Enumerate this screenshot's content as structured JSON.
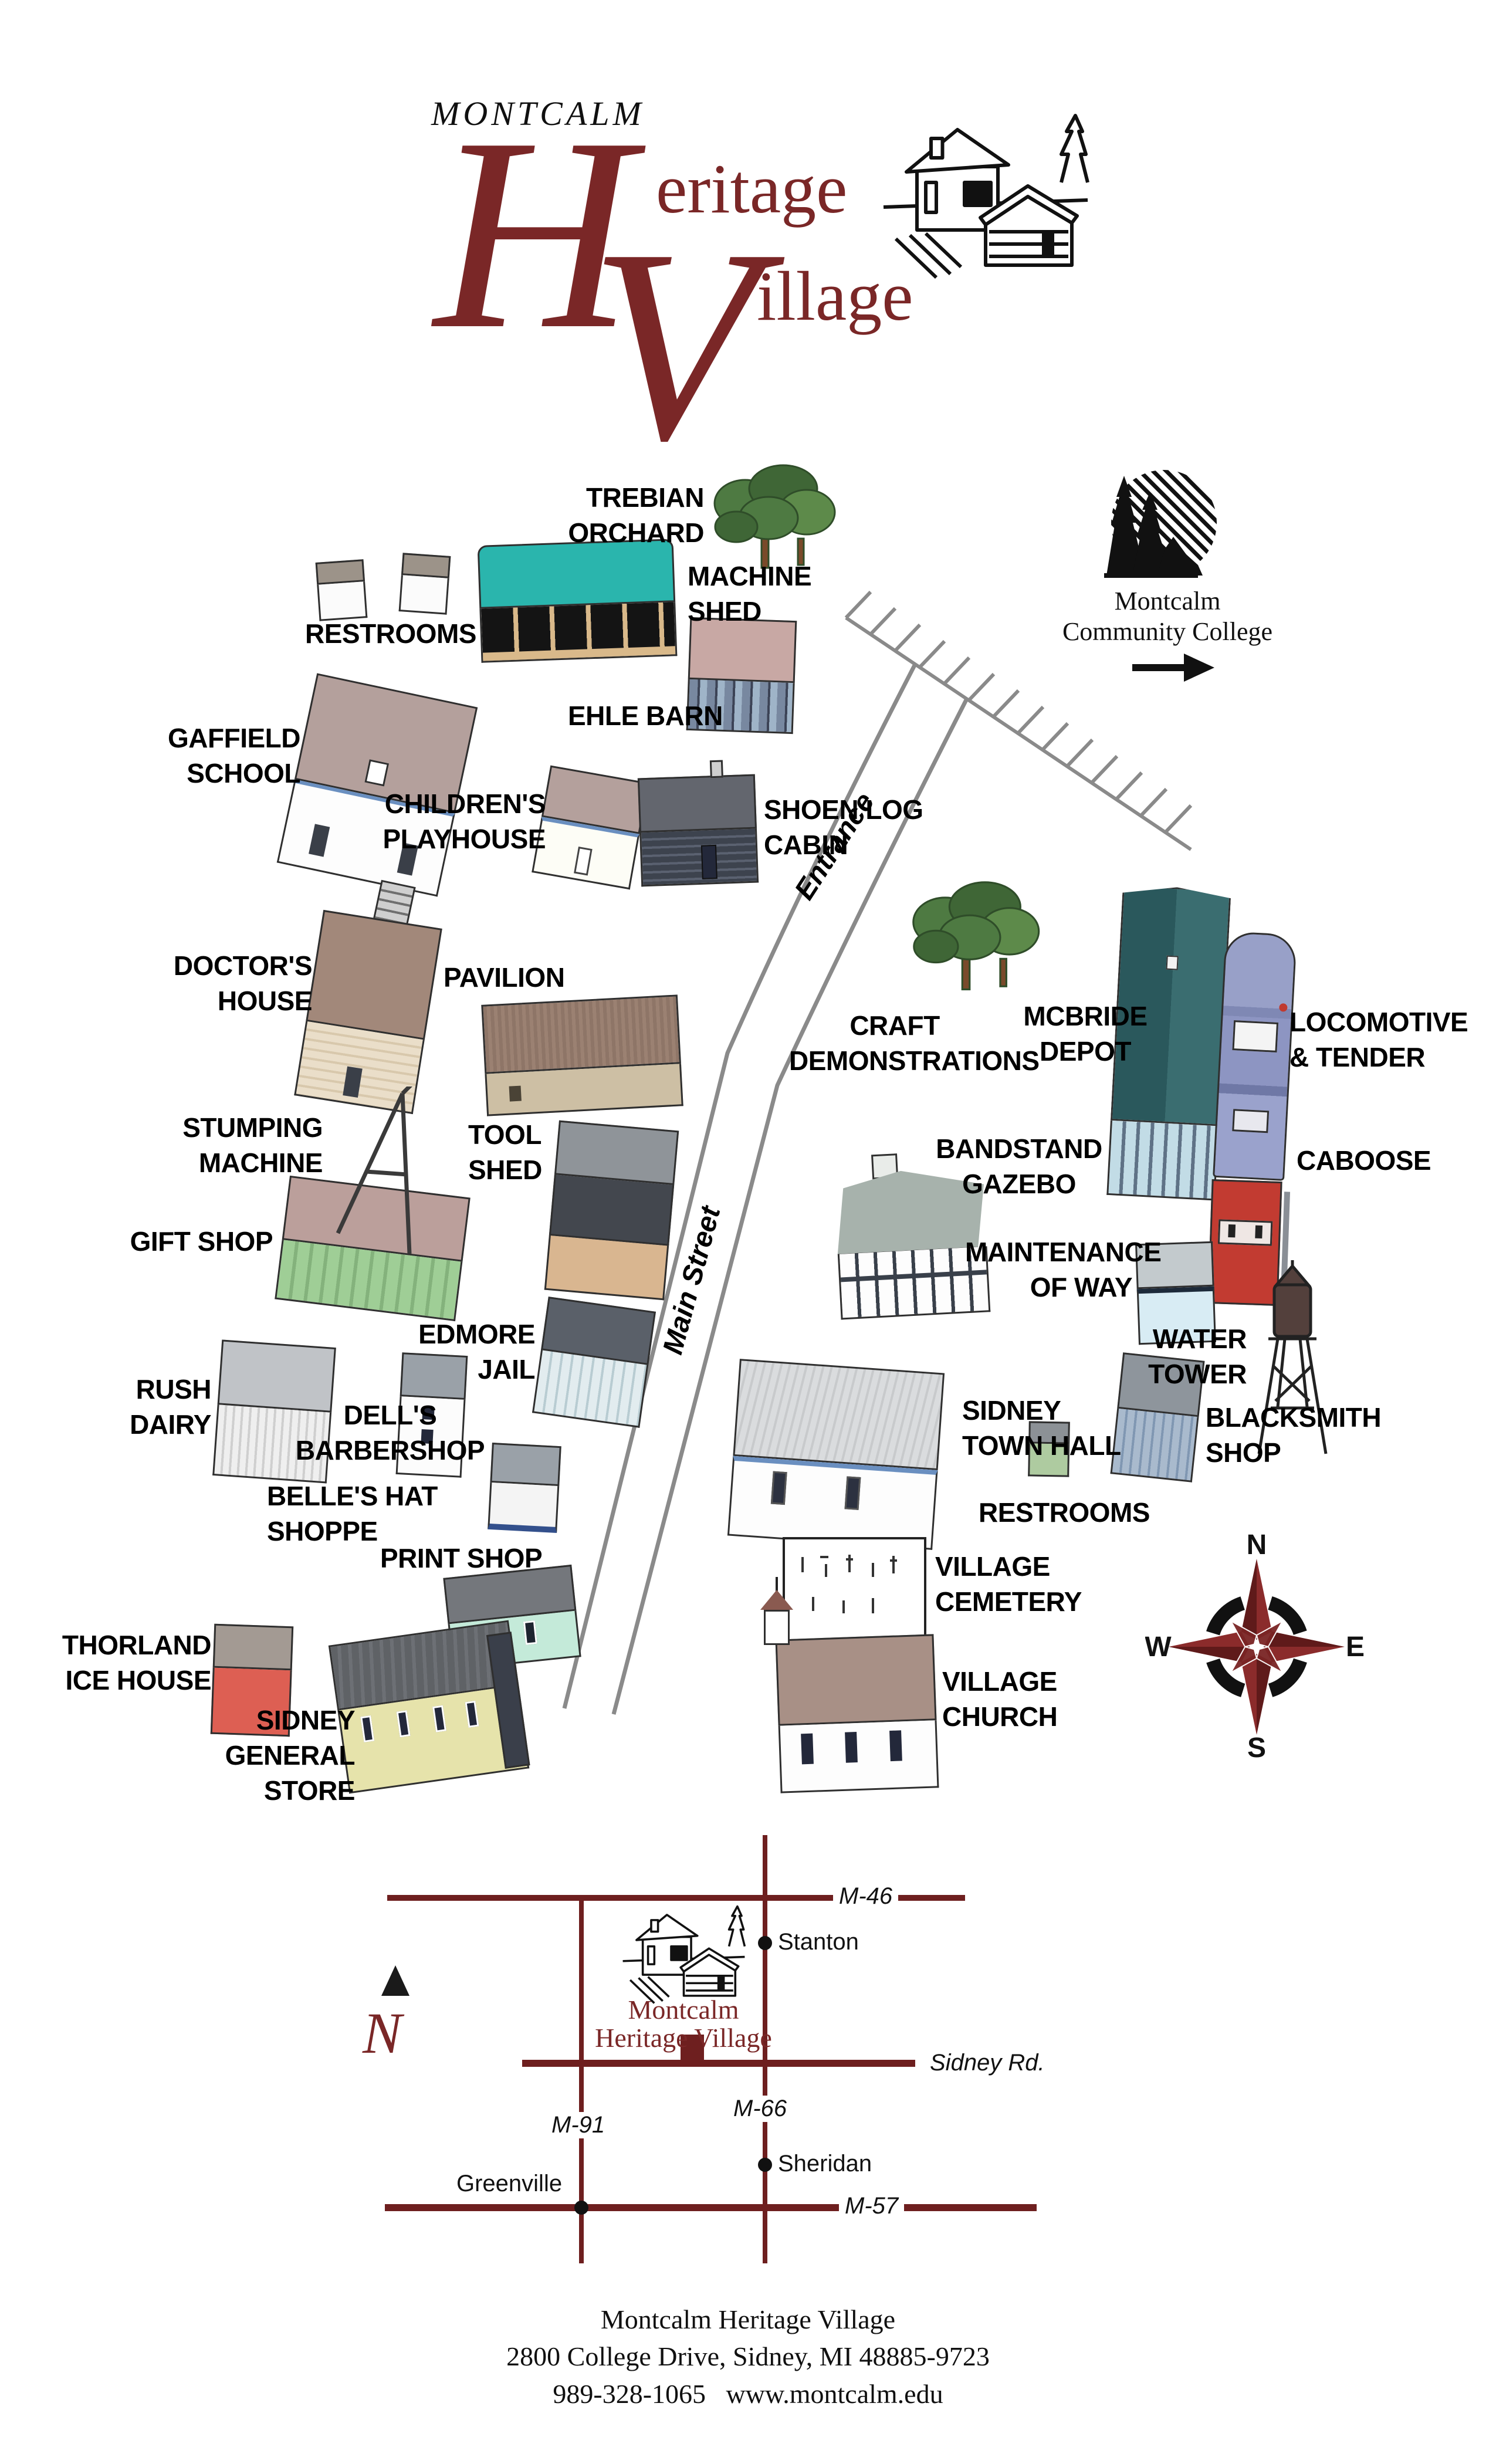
{
  "logo": {
    "kicker": "MONTCALM",
    "heritage_initial": "H",
    "heritage_rest": "eritage",
    "village_initial": "V",
    "village_rest": "illage"
  },
  "college": {
    "line1": "Montcalm",
    "line2": "Community College"
  },
  "roads": {
    "entrance": "Entrance",
    "main_street": "Main Street"
  },
  "labels": {
    "trebian": [
      "TREBIAN",
      "ORCHARD"
    ],
    "machine_shed": [
      "MACHINE",
      "SHED"
    ],
    "restrooms_nw": [
      "RESTROOMS"
    ],
    "ehle_barn": [
      "EHLE BARN"
    ],
    "gaffield": [
      "GAFFIELD",
      "SCHOOL"
    ],
    "childrens": [
      "CHILDREN'S",
      "PLAYHOUSE"
    ],
    "shoen": [
      "SHOEN LOG",
      "CABIN"
    ],
    "doctors": [
      "DOCTOR'S",
      "HOUSE"
    ],
    "pavilion": [
      "PAVILION"
    ],
    "craft": [
      "CRAFT",
      "DEMONSTRATIONS"
    ],
    "mcbride": [
      "MCBRIDE",
      "DEPOT"
    ],
    "locomotive": [
      "LOCOMOTIVE",
      "& TENDER"
    ],
    "caboose": [
      "CABOOSE"
    ],
    "stumping": [
      "STUMPING",
      "MACHINE"
    ],
    "tool_shed": [
      "TOOL",
      "SHED"
    ],
    "gift_shop": [
      "GIFT SHOP"
    ],
    "bandstand": [
      "BANDSTAND",
      "GAZEBO"
    ],
    "maintenance": [
      "MAINTENANCE",
      "OF WAY"
    ],
    "water_tower": [
      "WATER",
      "TOWER"
    ],
    "edmore": [
      "EDMORE",
      "JAIL"
    ],
    "rush": [
      "RUSH",
      "DAIRY"
    ],
    "dells": [
      "DELL'S",
      "BARBERSHOP"
    ],
    "belles": [
      "BELLE'S HAT SHOPPE"
    ],
    "town_hall": [
      "SIDNEY",
      "TOWN HALL"
    ],
    "restrooms_se": [
      "RESTROOMS"
    ],
    "blacksmith": [
      "BLACKSMITH",
      "SHOP"
    ],
    "print_shop": [
      "PRINT SHOP"
    ],
    "thorland": [
      "THORLAND",
      "ICE HOUSE"
    ],
    "general_store": [
      "SIDNEY",
      "GENERAL STORE"
    ],
    "cemetery": [
      "VILLAGE",
      "CEMETERY"
    ],
    "church": [
      "VILLAGE",
      "CHURCH"
    ]
  },
  "compass": {
    "n": "N",
    "e": "E",
    "s": "S",
    "w": "W"
  },
  "inset": {
    "m46": "M-46",
    "m91": "M-91",
    "m66": "M-66",
    "m57": "M-57",
    "sidney_rd": "Sidney Rd.",
    "stanton": "Stanton",
    "sheridan": "Sheridan",
    "greenville": "Greenville",
    "mhv_line1": "Montcalm",
    "mhv_line2": "Heritage Village",
    "north": "N"
  },
  "footer": {
    "line1": "Montcalm Heritage Village",
    "line2": "2800 College Drive, Sidney, MI 48885-9723",
    "line3": "989-328-1065   www.montcalm.edu"
  },
  "colors": {
    "brand_maroon": "#7a2727",
    "compass_red": "#6e2020",
    "inset_road_red": "#6e1f1f",
    "road_gray": "#8a8a8a",
    "machine_shed_teal": "#2ab5ad",
    "depot_teal": "#2e5f62",
    "caboose_red": "#c23b31",
    "ice_house_red": "#dd5f53",
    "store_yellow": "#e6e3ab",
    "gift_green": "#9fce96"
  }
}
